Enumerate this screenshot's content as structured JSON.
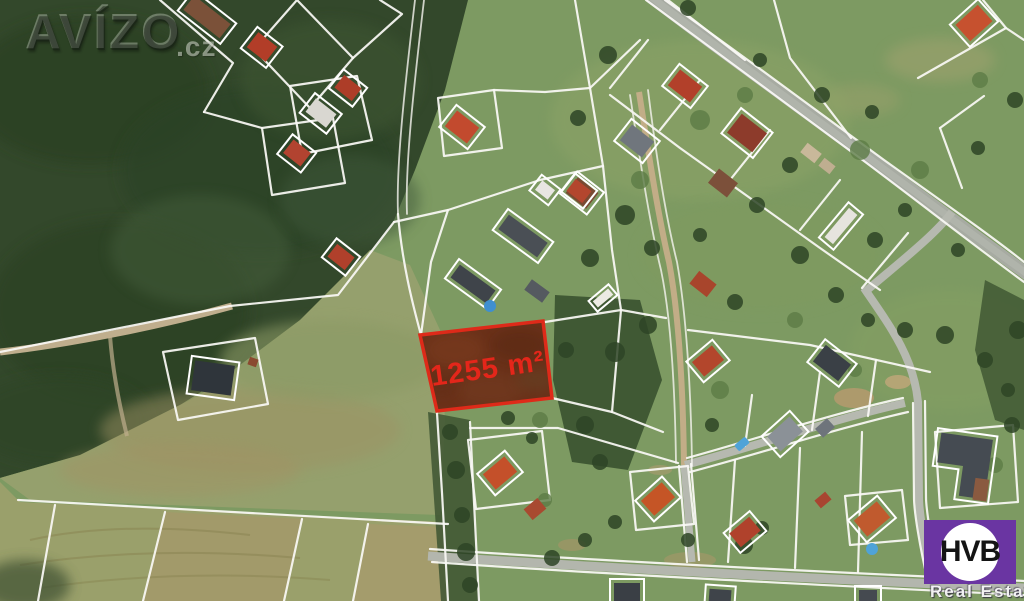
{
  "watermark": {
    "brand": "AVÍZO",
    "suffix": ".cz"
  },
  "highlight": {
    "area_label": "1255 m²",
    "border_color": "#de2a19",
    "fill_color": "#8f2511",
    "label_color": "#e4261a"
  },
  "agency": {
    "monogram": "HVB",
    "subtitle": "Real Estate",
    "brand_color": "#6a35a2",
    "circle_color": "#ffffff",
    "monogram_color": "#141414"
  },
  "palette": {
    "forest": "#33482b",
    "grass": "#7d9a62",
    "meadow": "#95a06d",
    "field_strip": "#a2936a",
    "road_asphalt": "#a7aba2",
    "dirt_road": "#c2ad87",
    "cadastral_line": "#ffffff",
    "roof_red": "#b5402a",
    "roof_gray": "#4a4f55",
    "pool_blue": "#4fa3d8"
  }
}
